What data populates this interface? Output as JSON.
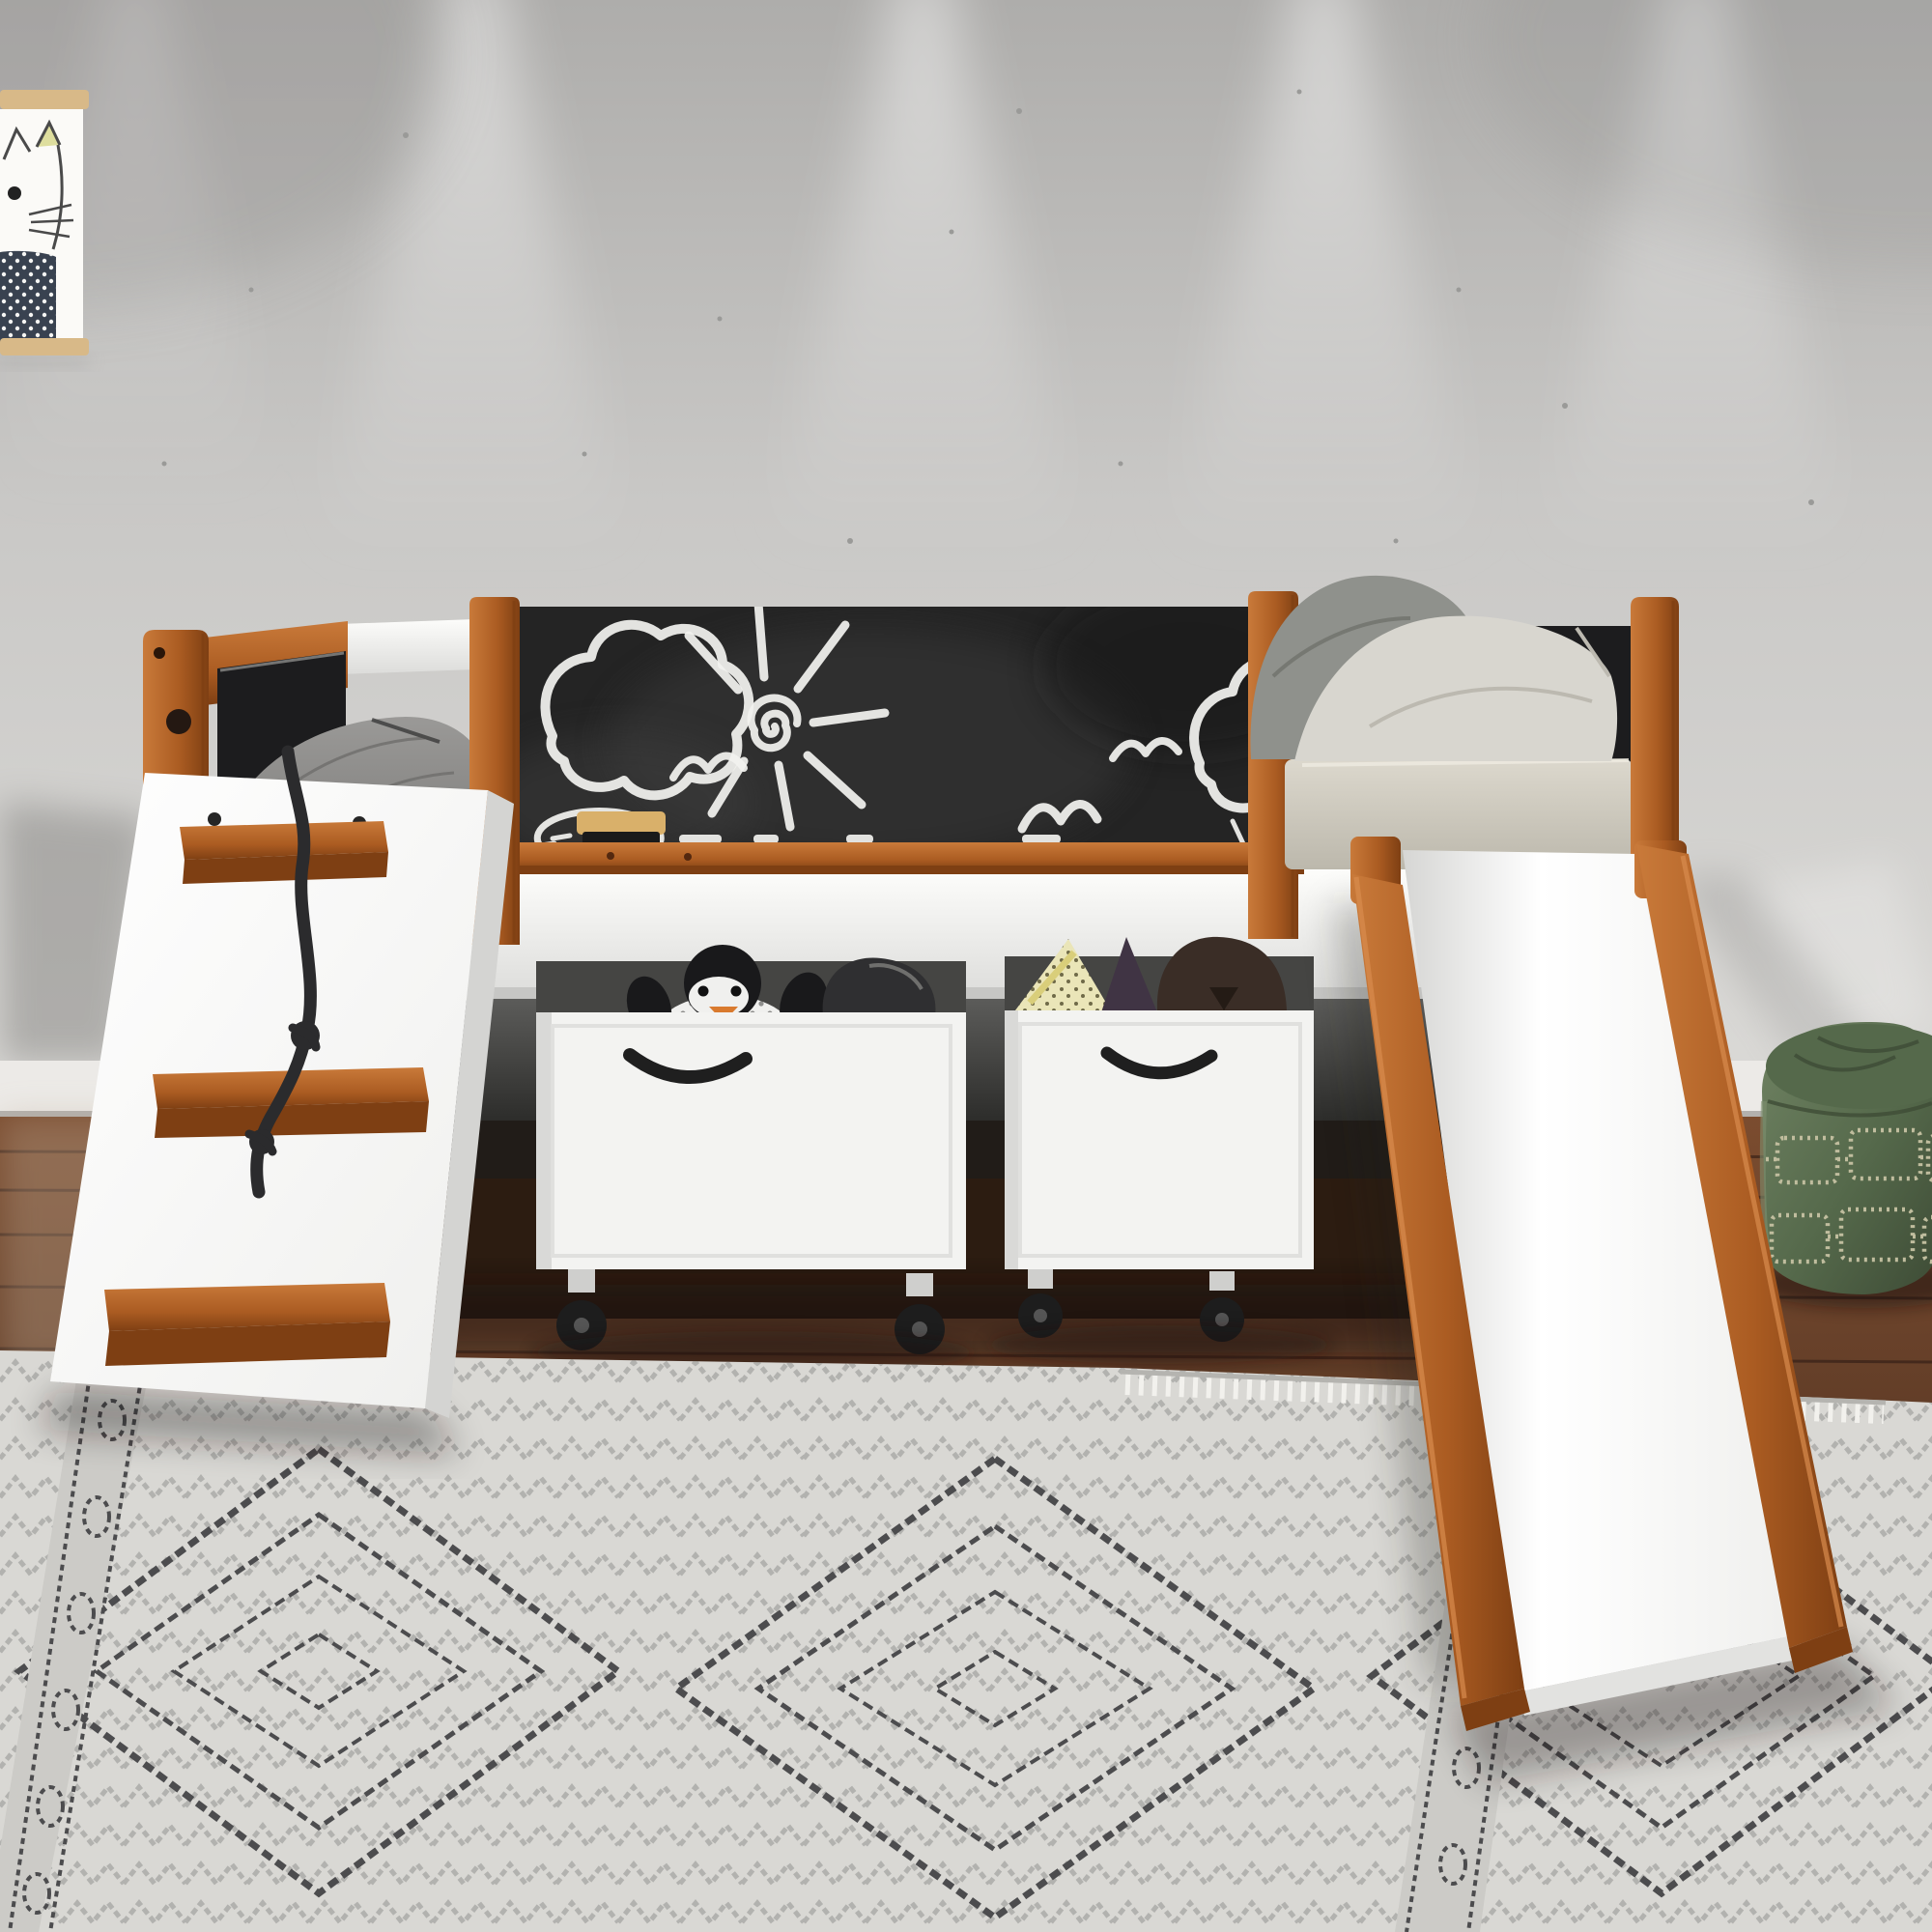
{
  "meta": {
    "kind": "product-photograph",
    "subject": "kids low loft bed with chalkboard panel, climbing ramp and slide in a bedroom"
  },
  "scene": {
    "wall": "textured light-gray wall washed by ceiling spotlights",
    "poster": "cat illustration print on wooden poster hanger, top-left, partially cropped",
    "bed": "twin low loft bed, white frame with cherry wood posts and trim",
    "chalkboard": "black chalkboard front panel with chalk drawings of clouds, a sun and birds, wooden chalk tray with eraser and chalk pieces",
    "headboard": "left headboard with black upholstered insert and wood frame",
    "bedding": "gray blanket on left, beige mattress with one dark-gray and one light-gray pillow on right",
    "ramp": "white angled climbing ramp with three wood grip steps and a knotted black climbing rope",
    "slide": "white slide with cherry wood side rails descending to the right",
    "bins": "two white rolling toy boxes under the bed with plush toys (penguin, polka-dot triangle, purple cone, brown bear)",
    "pouf": "green quilted leather pouf at right edge, partially cropped",
    "floor": "dark walnut plank floor",
    "rug": "light gray area rug with dark tribal diamond pattern and fringe"
  },
  "colors": {
    "wall-base": "#c9c8c6",
    "wall-dark": "#aeadab",
    "wall-light": "#dbdad7",
    "baseboard": "#eceae7",
    "wood-light": "#c97a3a",
    "wood-mid": "#ab5c22",
    "wood-dark": "#7e3f13",
    "chalk-board": "#242424",
    "chalk-white": "#f2f2ef",
    "black-panel": "#1c1c1e",
    "white-paint": "#f6f6f4",
    "white-shadow": "#dcdcda",
    "blanket-gray": "#7b7a78",
    "mattress-beige": "#dcd8cd",
    "mattress-shadow": "#bcb8ac",
    "pillow-dark": "#8f918c",
    "pillow-light": "#d8d6cf",
    "floor-light": "#7b4c2f",
    "floor-mid": "#5c3a26",
    "floor-dark": "#3f2517",
    "floor-seam": "#2a1812",
    "under-gray": "#5e5e5c",
    "under-dark": "#262624",
    "bin-white": "#f3f3f1",
    "bin-shadow": "#d9d9d7",
    "handle-black": "#1f1f1f",
    "rope-black": "#2b2b2d",
    "penguin-black": "#19191b",
    "penguin-orange": "#d97a2e",
    "toy-yellow": "#eae5b8",
    "toy-purple": "#403444",
    "toy-brown": "#3a2d26",
    "rug-base": "#d9d8d4",
    "rug-mid": "#8b8b89",
    "rug-dark": "#4c4c4e",
    "rug-fringe": "#f2f1ed",
    "pouf-green": "#55694b",
    "pouf-light": "#6f8262",
    "pouf-dark": "#3e4c36",
    "pouf-stitch": "#c0bd9e",
    "poster-wood": "#d8b988",
    "poster-bg": "#fbfaf7",
    "cat-ink": "#4a4a4a",
    "cat-body": "#394250",
    "cat-ear": "#dede9e"
  }
}
